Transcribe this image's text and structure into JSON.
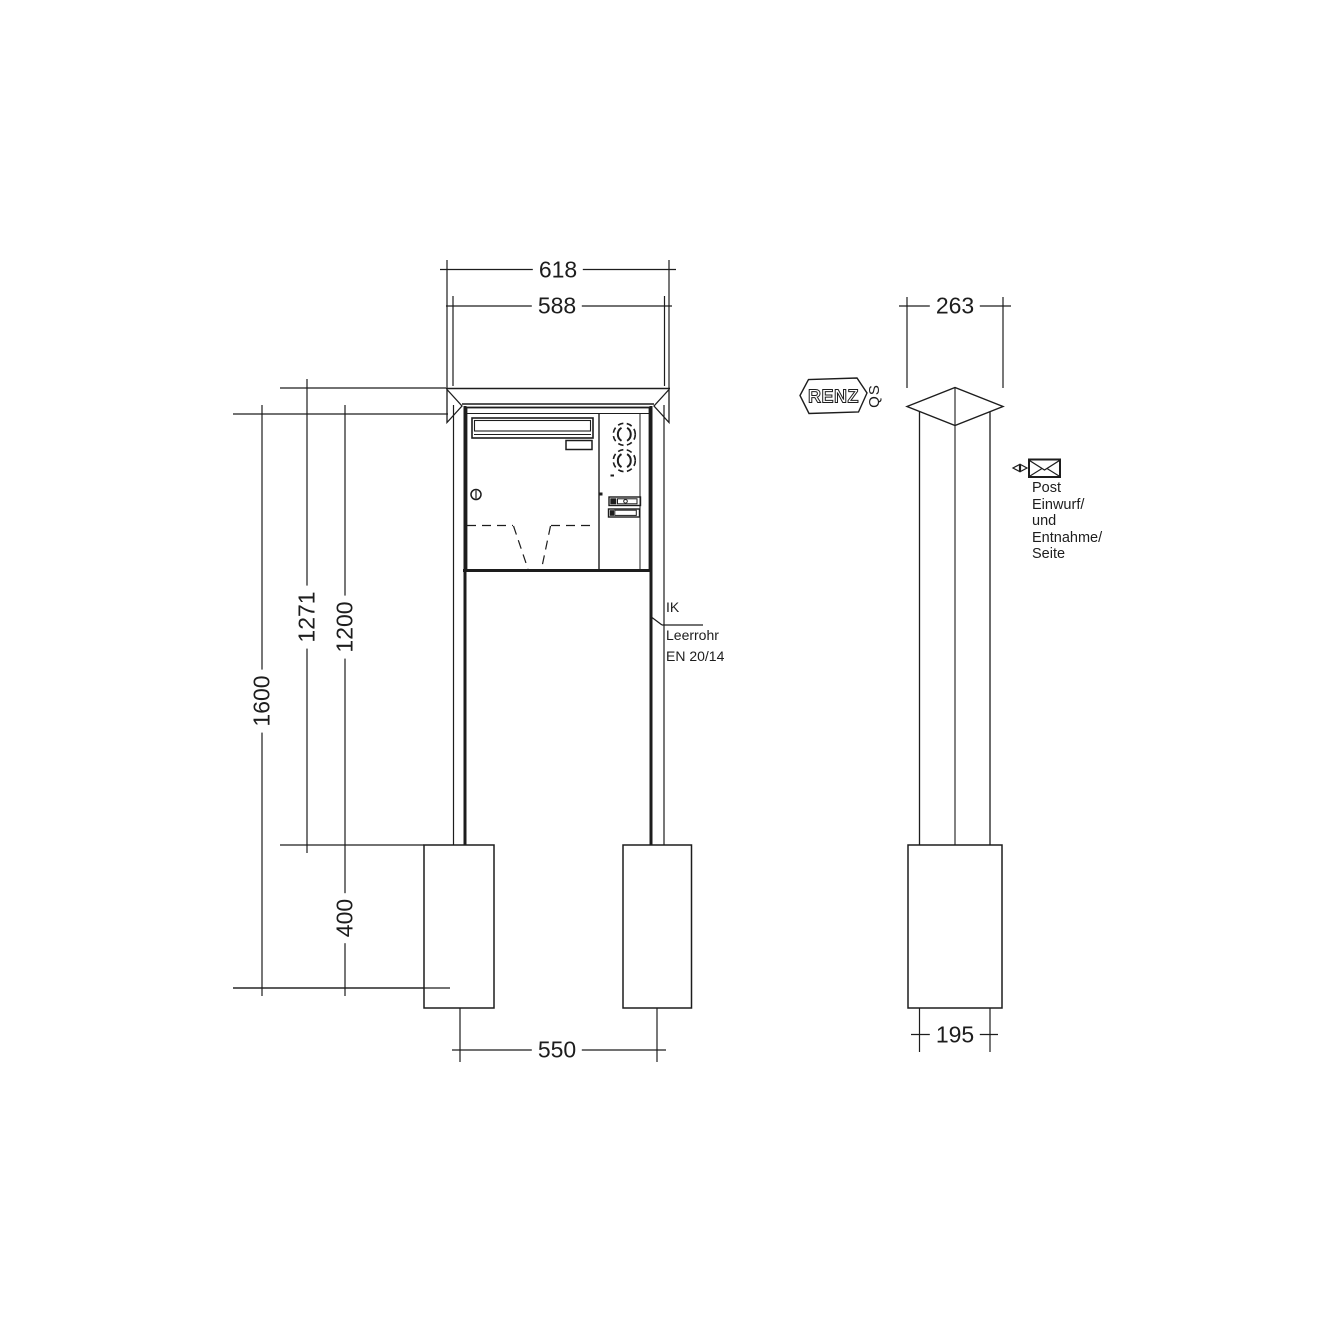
{
  "front_view": {
    "dims": {
      "width_cap": "618",
      "width_body": "588",
      "height_total": "1600",
      "height_top_to_anchor": "1271",
      "height_body_top_to_anchor": "1200",
      "anchor_depth": "400",
      "post_spacing": "550"
    },
    "callout": {
      "line1": "IK",
      "line2": "Leerrohr",
      "line3": "EN 20/14"
    }
  },
  "side_view": {
    "dims": {
      "depth_cap": "263",
      "depth_post": "195"
    },
    "brand_logo": "RENZ",
    "qs_mark": "QS",
    "note_lines": [
      "Post",
      "Einwurf/",
      "und",
      "Entnahme/",
      "Seite"
    ]
  },
  "colors": {
    "line": "#1d1d1d",
    "background": "#ffffff"
  }
}
